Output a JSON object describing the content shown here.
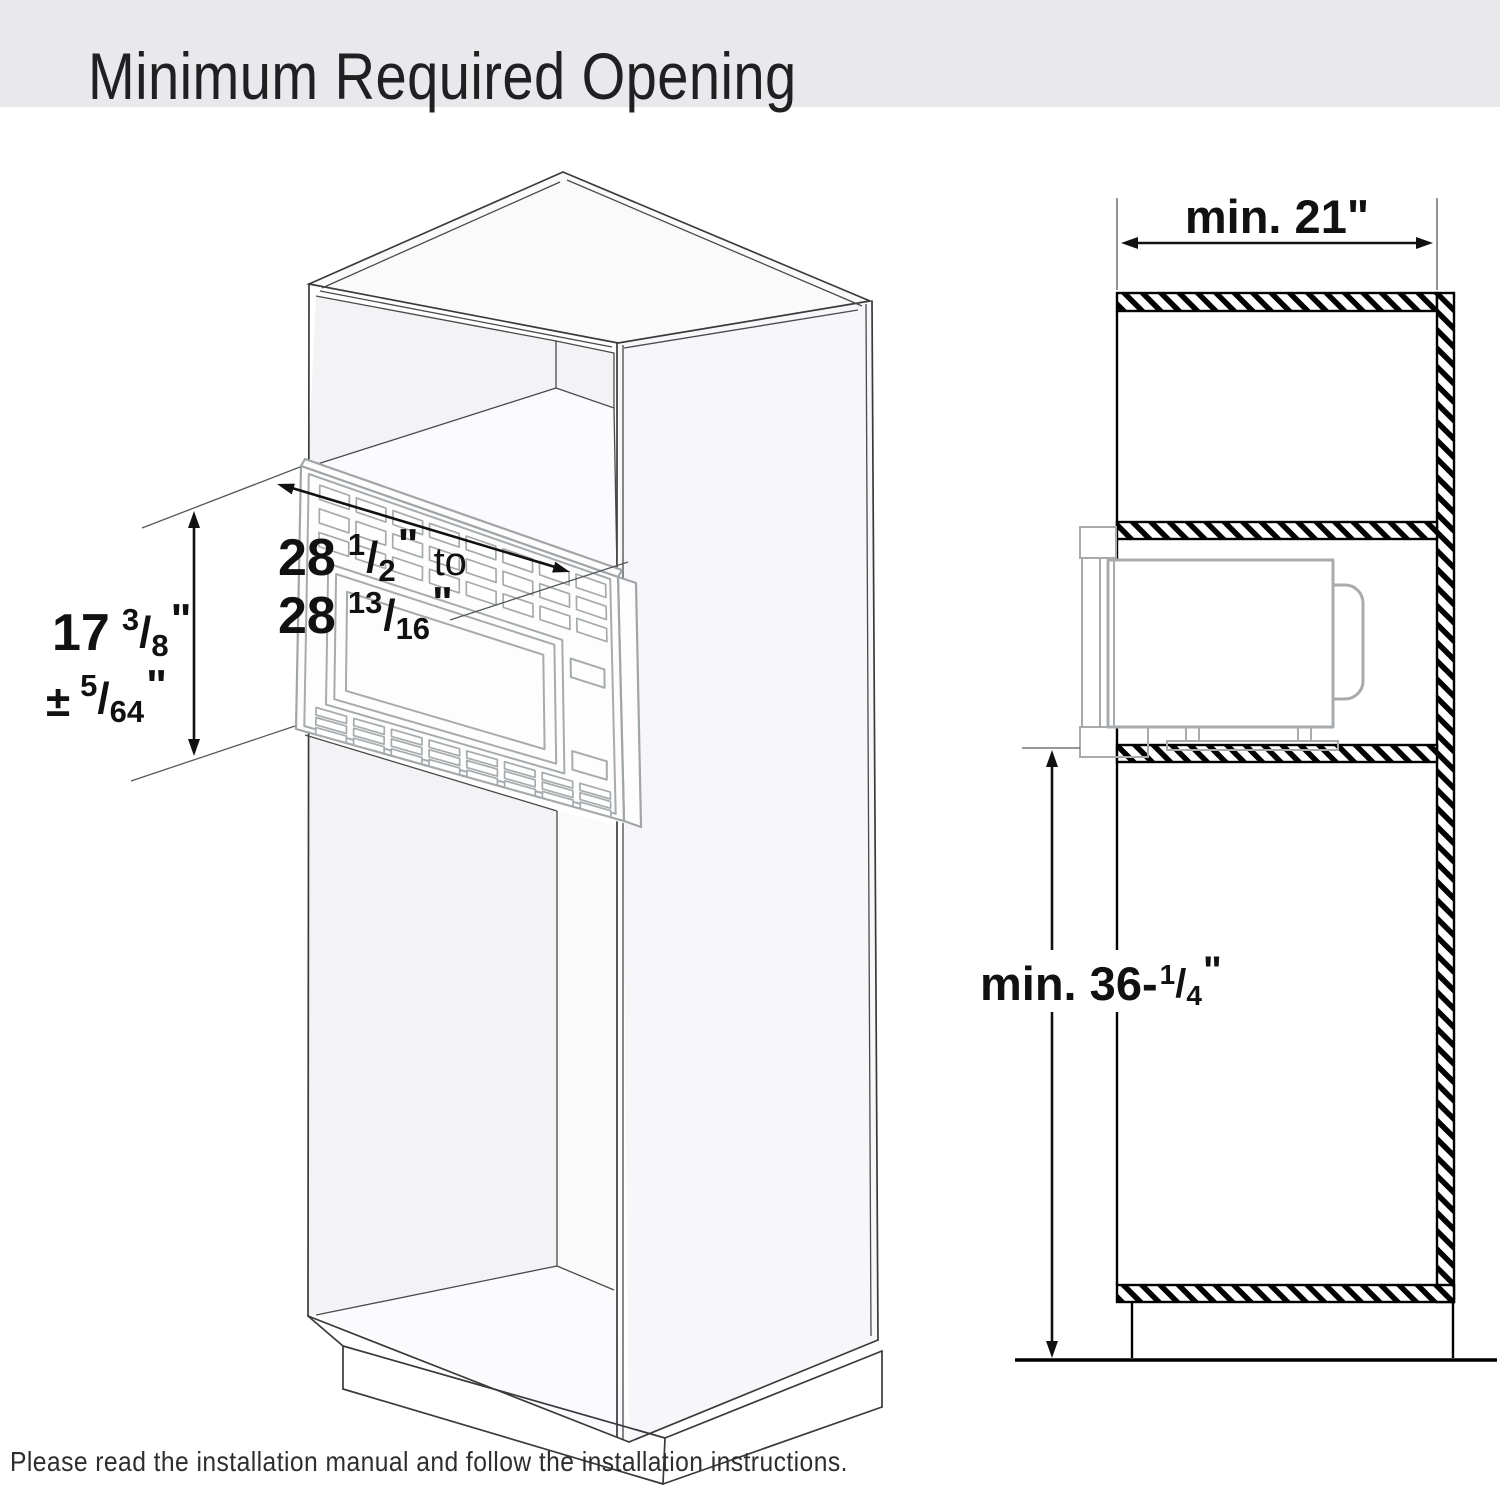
{
  "title": "Minimum Required Opening",
  "footer_note": "Please read the installation manual and follow the installation instructions.",
  "front_view": {
    "width_dim": {
      "l1_whole": "28",
      "l1_num": "1",
      "l1_slash": "/",
      "l1_den": "2",
      "l1_unit": "\"",
      "l1_conj": " to",
      "l2_whole": "28",
      "l2_num": "13",
      "l2_slash": "/",
      "l2_den": "16",
      "l2_unit": "\""
    },
    "height_dim": {
      "l1_whole": "17",
      "l1_num": "3",
      "l1_slash": "/",
      "l1_den": "8",
      "l1_unit": "\"",
      "l2_pm": "±",
      "l2_num": "5",
      "l2_slash": "/",
      "l2_den": "64",
      "l2_unit": "\""
    }
  },
  "side_view": {
    "width_label": "min. 21",
    "width_unit": "\"",
    "height_prefix": "min. 36-",
    "height_num": "1",
    "height_slash": "/",
    "height_den": "4",
    "height_unit": "\""
  },
  "colors": {
    "banner_bg": "#e9e9eb",
    "section_line": "#000000",
    "cabinet_line": "#3a3a3c",
    "trim_line": "#a6abad",
    "text": "#111111"
  }
}
